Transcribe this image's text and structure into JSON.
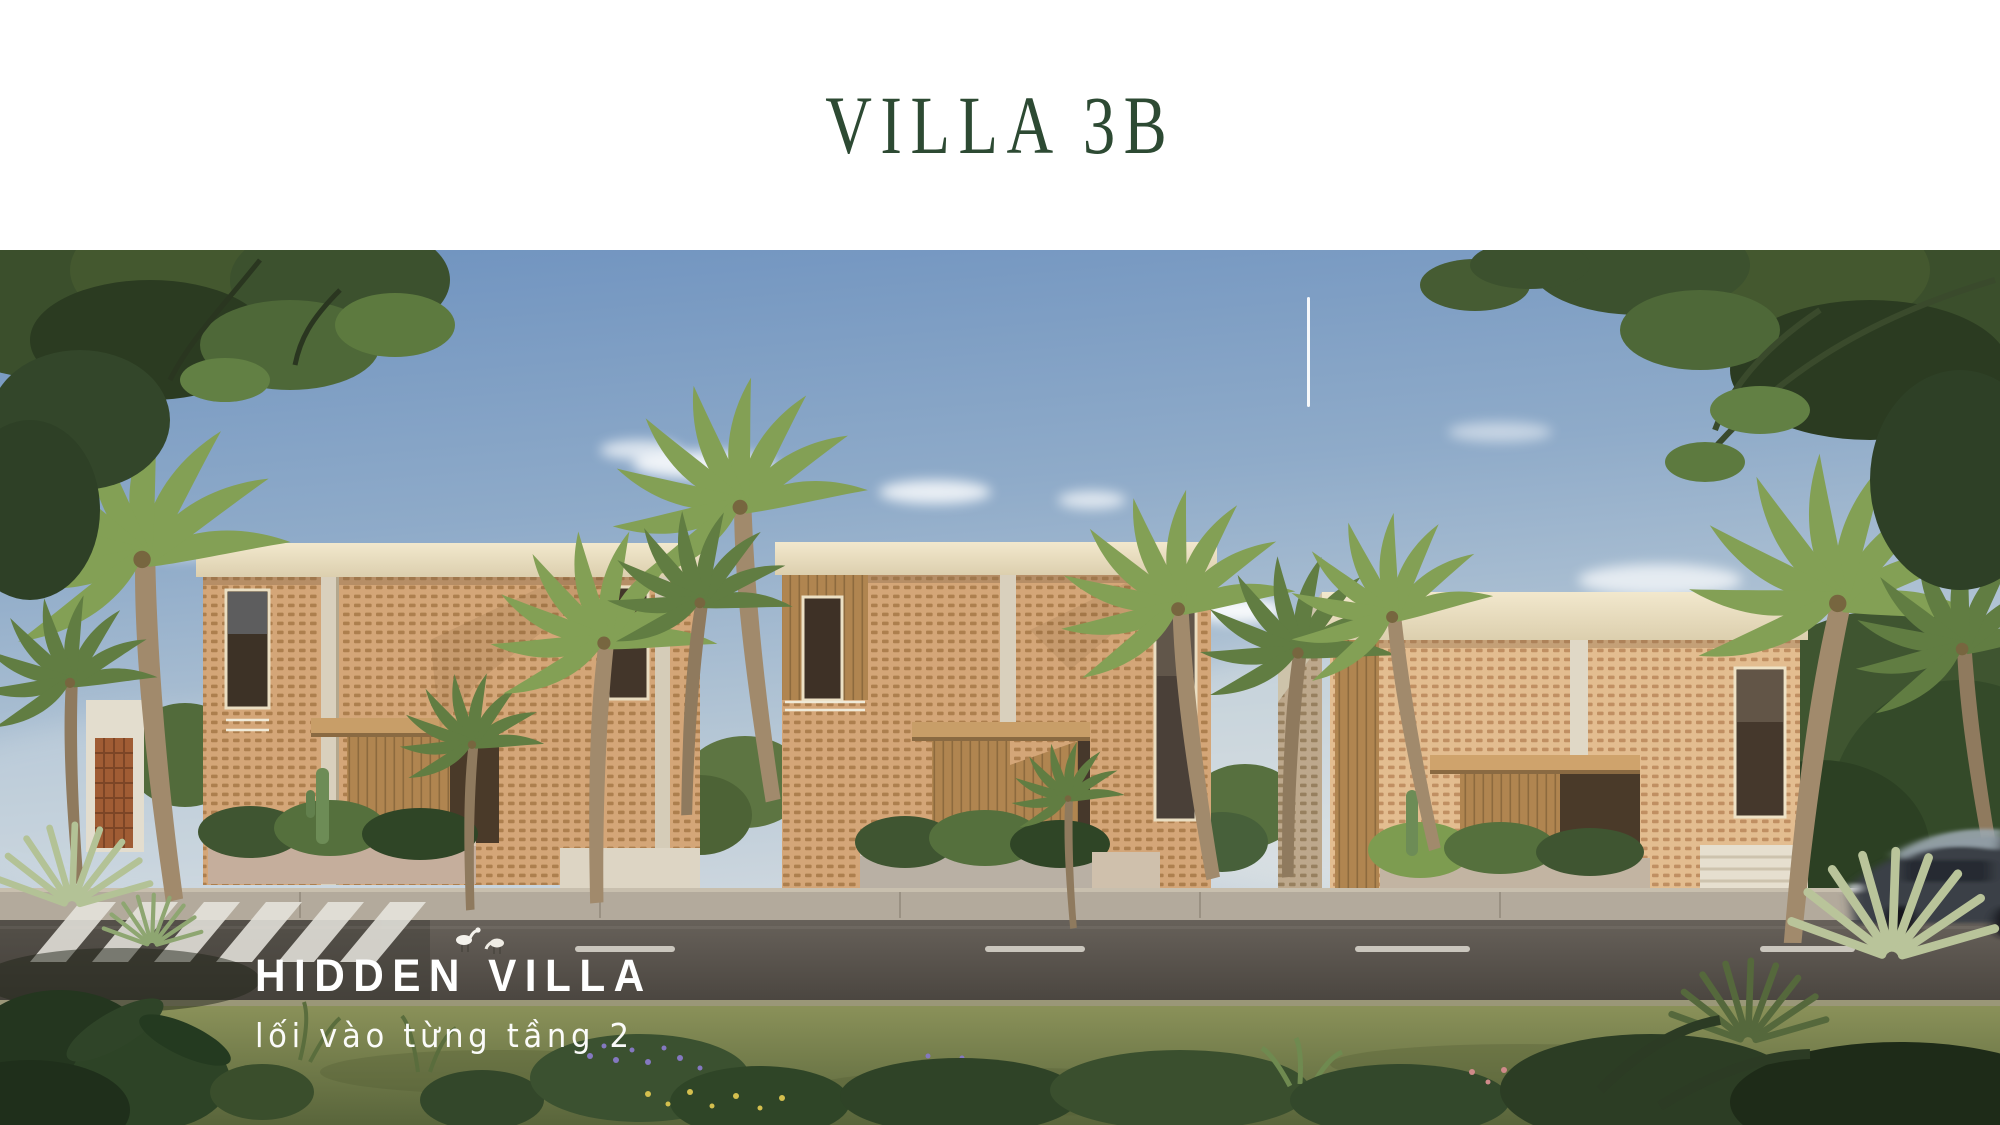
{
  "header": {
    "title": "VILLA 3B"
  },
  "hero": {
    "caption_title": "HIDDEN VILLA",
    "caption_subtitle": "lối vào từng tầng 2"
  },
  "scene_description": {
    "subject": "three-villa-street-elevation-render",
    "elements": [
      "tropical-sky",
      "clouds",
      "three-lattice-facade-villas",
      "palm-trees",
      "street-with-crosswalk",
      "white-egrets",
      "blurred-car",
      "foreground-garden",
      "overhanging-tree-canopies",
      "white-vertical-divider-line"
    ]
  },
  "colors": {
    "title-green": "#2d4a33",
    "caption-white": "#ffffff",
    "sky-top": "#6e92bf",
    "sky-horizon": "#ccd6de",
    "roof-cream": "#f0e6cb",
    "lattice-terracotta": "#d4a678",
    "lattice-hole": "#ad7f4e",
    "wood-warm": "#b08550",
    "road-asphalt": "#57524b",
    "lawn-olive": "#76804e",
    "foliage-dark": "#34462a"
  }
}
